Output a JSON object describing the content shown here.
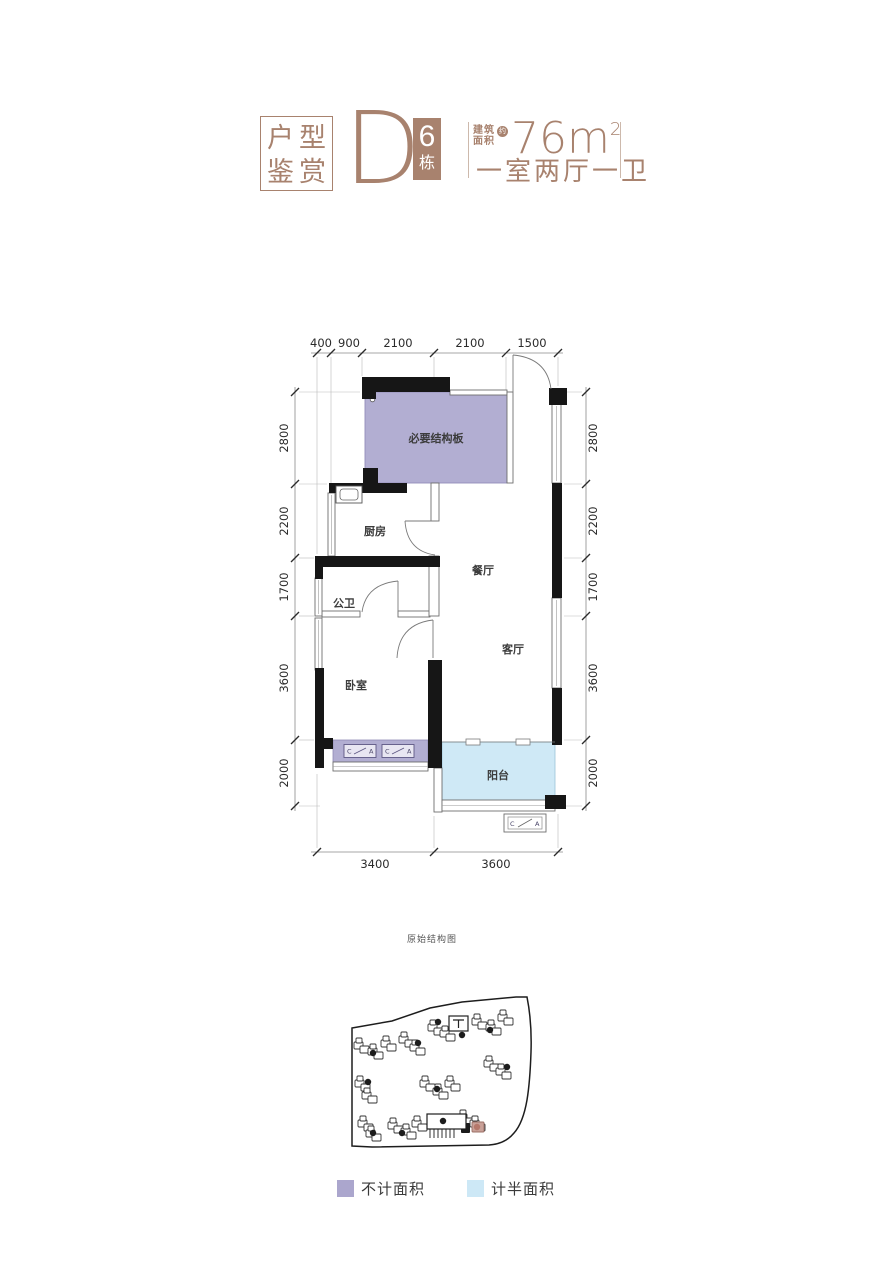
{
  "header": {
    "gallery_line1": "户型",
    "gallery_line2": "鉴赏",
    "unit_letter": "D",
    "building_num": "6",
    "building_suffix": "栋",
    "area_prefix_1": "建筑",
    "area_prefix_2": "面积",
    "approx_mark": "约",
    "area_value": "76m",
    "area_exponent": "2",
    "layout_desc": "一室两厅一卫"
  },
  "plan": {
    "dims_top": [
      "400",
      "900",
      "2100",
      "2100",
      "1500"
    ],
    "dims_left": [
      "2800",
      "2200",
      "1700",
      "3600",
      "2000"
    ],
    "dims_right": [
      "2800",
      "2200",
      "1700",
      "3600",
      "2000"
    ],
    "dims_bottom": [
      "3400",
      "3600"
    ],
    "rooms": {
      "structure_slab": "必要结构板",
      "kitchen": "厨房",
      "dining": "餐厅",
      "guest_bath": "公卫",
      "living": "客厅",
      "bedroom": "卧室",
      "balcony": "阳台"
    },
    "ac_c": "C",
    "ac_a": "A"
  },
  "sitemap": {
    "title": "原始结构图"
  },
  "legend": {
    "no_area_label": "不计面积",
    "half_area_label": "计半面积"
  },
  "colors": {
    "brand_brown": "#a8826e",
    "no_area_purple": "#b2aed2",
    "half_area_blue": "#cfe9f6",
    "wall_black": "#161616"
  }
}
